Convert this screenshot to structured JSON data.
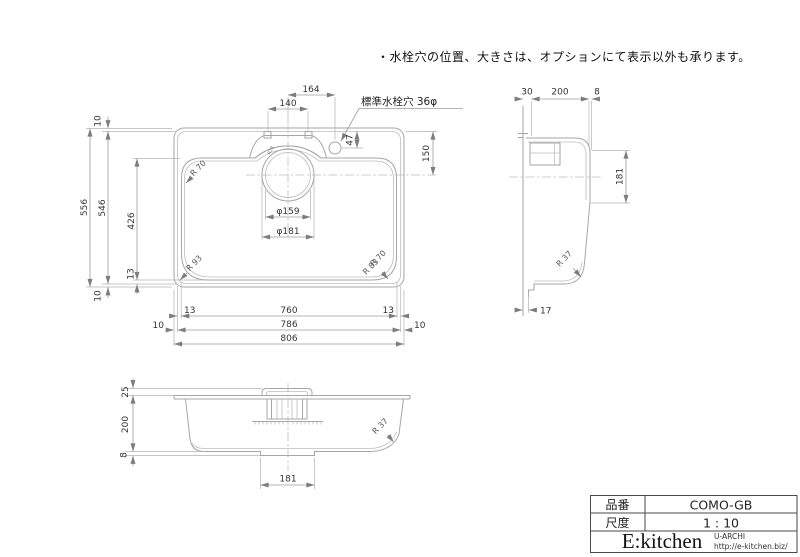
{
  "note": "・水栓穴の位置、大きさは、オプションにて表示以外も承ります。",
  "plan_view": {
    "faucet_note": "標準水栓穴 36φ",
    "dims": {
      "d164": "164",
      "d140": "140",
      "d47": "47",
      "d150": "150",
      "d556": "556",
      "d546": "546",
      "d10_top": "10",
      "d426": "426",
      "d13_left": "13",
      "d10_bottom": "10",
      "d13_bl": "13",
      "d760": "760",
      "d13_br": "13",
      "d10_l": "10",
      "d786": "786",
      "d10_r": "10",
      "d806": "806",
      "dia159": "φ159",
      "dia181": "φ181"
    },
    "radii": {
      "top_left": "R 70",
      "bottom_left": "R 93",
      "bottom_right_a": "R 70",
      "bottom_right_b": "R 83",
      "deck": "R28"
    }
  },
  "side_view": {
    "dims": {
      "d30": "30",
      "d200": "200",
      "d8": "8",
      "d181": "181",
      "d17": "17"
    },
    "radii": {
      "front_bottom": "R 37"
    }
  },
  "front_view": {
    "dims": {
      "d25": "25",
      "d200": "200",
      "d8": "8",
      "d181": "181"
    },
    "radii": {
      "bottom_right": "R 37"
    }
  },
  "title_block": {
    "part_no_label": "品番",
    "part_no_value": "COMO-GB",
    "scale_label": "尺度",
    "scale_value": "1 : 10",
    "brand": "E:kitchen",
    "brand_sub": "U-ARCHI",
    "brand_url": "http://e-kitchen.biz/"
  }
}
